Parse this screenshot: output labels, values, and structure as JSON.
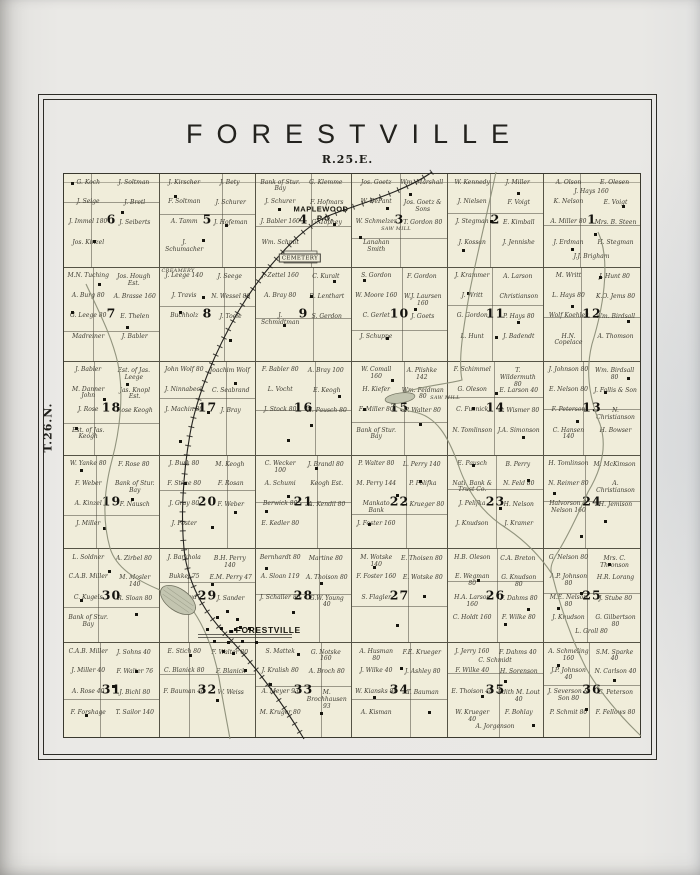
{
  "plate": {
    "title": "FORESTVILLE",
    "range_label": "R.25.E.",
    "township_label": "T.26.N."
  },
  "colors": {
    "paper": "#e8e7e4",
    "map_fill": "#f0edda",
    "grid_line": "#555345",
    "water": "#8b8e78",
    "railroad": "#23221e",
    "ink": "#17160f"
  },
  "map": {
    "sections": [
      {
        "number": 6,
        "names": [
          "G. Koch",
          "J. Soltman",
          "J. Seige",
          "J. Bretl",
          "J. Immel 180",
          "J. Seiberts",
          "Jos. Kinzel"
        ]
      },
      {
        "number": 5,
        "names": [
          "J. Kirscher",
          "J. Bety",
          "F. Soltman",
          "J. Schurer",
          "A. Tamm",
          "J. Hofeman",
          "J. Schumacher"
        ]
      },
      {
        "number": 4,
        "names": [
          "Bank of Stur. Bay",
          "G. Klemme",
          "J. Schurer",
          "F. Hofmars",
          "J. Babler 160",
          "G. Tophey",
          "Wm. Schmit"
        ]
      },
      {
        "number": 3,
        "names": [
          "Jos. Goetz",
          "Wm. Marshall",
          "W. DeFant",
          "Jos. Goetz & Sons",
          "W. Schmelzer",
          "T. Gordon 80",
          "Lanahan Smith"
        ]
      },
      {
        "number": 2,
        "names": [
          "W. Kennedy",
          "J. Miller",
          "J. Nielsen",
          "F. Voigt",
          "J. Stegman",
          "E. Kimball",
          "J. Kossan",
          "J. Jennishe"
        ]
      },
      {
        "number": 1,
        "names": [
          "A. Olson",
          "E. Olesen",
          "K. Nelson",
          "E. Voigt",
          "A. Miller 80",
          "Mrs. B. Steen",
          "J. Erdman",
          "H. Stegman",
          "J.J. Brigham",
          "J. Hays 160"
        ]
      },
      {
        "number": 7,
        "names": [
          "M.N. Tuching",
          "Jos. Hough Est.",
          "A. Burg 80",
          "A. Brasse 160",
          "G. Leege 80",
          "E. Thelen",
          "Madreiner",
          "J. Babler"
        ]
      },
      {
        "number": 8,
        "names": [
          "J. Leege 140",
          "J. Seege",
          "J. Travis",
          "N. Wessel 80",
          "Buchholz",
          "J. Toele"
        ]
      },
      {
        "number": 9,
        "names": [
          "J. Zettel 160",
          "C. Kuralt",
          "A. Bray 80",
          "R. Lenthart",
          "J. Schmidtman",
          "S. Gerdon"
        ]
      },
      {
        "number": 10,
        "names": [
          "S. Gordon",
          "F. Gordon",
          "W. Moore 160",
          "W.J. Laursen 160",
          "C. Gerlet",
          "J. Goets",
          "J. Schuppe"
        ]
      },
      {
        "number": 11,
        "names": [
          "J. Krammer",
          "A. Larson",
          "J. Writt",
          "Christianson",
          "G. Gordon",
          "P. Hays 80",
          "L. Hunt",
          "J. Badendt"
        ]
      },
      {
        "number": 12,
        "names": [
          "M. Writt",
          "J. Hunt 80",
          "L. Hays 80",
          "K.O. Jems 80",
          "Wolf Koehler",
          "Wm. Birdsall",
          "H.N. Copelace",
          "A. Thomson"
        ]
      },
      {
        "number": 18,
        "names": [
          "J. Babler",
          "Est. of Jas. Leege",
          "M. Danner John",
          "Jas. Knopl Est.",
          "J. Rose",
          "Rose Keogh",
          "Est. of Jas. Keogh"
        ]
      },
      {
        "number": 17,
        "names": [
          "John Wolf 80",
          "Joachim Wolf",
          "J. Ninnabeck",
          "C. Seabrand",
          "J. Machin 80",
          "J. Bray"
        ]
      },
      {
        "number": 16,
        "names": [
          "F. Babler 80",
          "A. Bray 100",
          "L. Vocht",
          "E. Keogh",
          "J. Stock 80",
          "H. Pausch 80"
        ]
      },
      {
        "number": 15,
        "names": [
          "W. Comall 160",
          "A. Plishke 142",
          "H. Kiefer",
          "Wm. Feldman 80",
          "F. Miller 80",
          "P. Walter 80",
          "Bank of Stur. Bay"
        ]
      },
      {
        "number": 14,
        "names": [
          "F. Schimmel",
          "T. Wildermuth 80",
          "G. Oleson",
          "E. Larson 40",
          "C. Fusnick",
          "C. Wismer 80",
          "N. Tomlinson",
          "J.A. Simonson"
        ]
      },
      {
        "number": 13,
        "names": [
          "J. Johnson 80",
          "Wm. Birdsall 80",
          "E. Nelson 80",
          "J. Fallis & Son",
          "F. Peterson",
          "N. Christianson",
          "C. Hansen 140",
          "H. Bowser"
        ]
      },
      {
        "number": 19,
        "names": [
          "W. Yanke 80",
          "F. Rose 80",
          "F. Weber",
          "Bank of Stur. Bay",
          "A. Kinzel",
          "F. Nausch",
          "J. Miller"
        ]
      },
      {
        "number": 20,
        "names": [
          "J. Burk 80",
          "M. Keogh",
          "F. Stilze 80",
          "F. Rosan",
          "J. Gray 80",
          "F. Weber",
          "J. Foster"
        ]
      },
      {
        "number": 21,
        "names": [
          "C. Wecker 100",
          "J. Brandl 80",
          "A. Schumi",
          "Keogh Est.",
          "Berwick 80",
          "A. Kendil 80",
          "E. Kedler 80"
        ]
      },
      {
        "number": 22,
        "names": [
          "P. Walter 80",
          "L. Perry 140",
          "M. Perry 144",
          "P. Polifka",
          "Mankato Bank",
          "C. Krueger 80",
          "J. Foster 160"
        ]
      },
      {
        "number": 23,
        "names": [
          "E. Pausch",
          "B. Perry",
          "Natl. Bank & Trust Co.",
          "N. Feld 80",
          "J. Pelifka",
          "H. Nelson",
          "J. Knudson",
          "J. Kramer"
        ]
      },
      {
        "number": 24,
        "names": [
          "H. Tomlinson",
          "M. McKimson",
          "N. Reimer 80",
          "A. Christianson",
          "Halvorson & Nelson 160",
          "H. Jemison"
        ]
      },
      {
        "number": 30,
        "names": [
          "L. Soldner",
          "A. Zirbel 80",
          "C.A.B. Miller",
          "M. Mosler 140",
          "C. Kugels",
          "R. Sloan 80",
          "Bank of Stur. Bay"
        ]
      },
      {
        "number": 29,
        "names": [
          "J. Barkhola",
          "B.H. Perry 140",
          "Bukkel 75",
          "E.M. Perry 47",
          "A. Rowd",
          "J. Sander"
        ]
      },
      {
        "number": 28,
        "names": [
          "Bernhardt 80",
          "Martine 80",
          "A. Sloan 119",
          "A. Thoison 80",
          "J. Schaller 80",
          "G.W. Young 40"
        ]
      },
      {
        "number": 27,
        "names": [
          "M. Wotske 140",
          "E. Thoisen 80",
          "F. Foster 160",
          "E. Wotske 80",
          "S. Flagler"
        ]
      },
      {
        "number": 26,
        "names": [
          "H.B. Oleson",
          "C.A. Breton",
          "E. Wegman 80",
          "G. Knudson 80",
          "H.A. Larson 160",
          "F. Dahms 80",
          "C. Holdt 160",
          "F. Wilke 80"
        ]
      },
      {
        "number": 25,
        "names": [
          "G. Nelson 80",
          "Mrs. C. Thronson",
          "A.P. Johnson 80",
          "H.R. Lorang",
          "M.E. Nelson 80",
          "J. Stube 80",
          "J. Knudson",
          "G. Gilbertson 80",
          "L. Groll 80"
        ]
      },
      {
        "number": 31,
        "names": [
          "C.A.B. Miller",
          "J. Sohns 40",
          "J. Miller 40",
          "F. Walter 76",
          "A. Rose 40",
          "J. Bichl 80",
          "F. Forshage",
          "T. Sailor 140"
        ]
      },
      {
        "number": 32,
        "names": [
          "E. Stich 80",
          "F. Walter 80",
          "C. Blanick 80",
          "F. Blanick",
          "F. Bauman 40",
          "W. Weiss"
        ]
      },
      {
        "number": 33,
        "names": [
          "S. Mattek",
          "G. Notske 160",
          "J. Kralish 80",
          "A. Broch 80",
          "A. Meyer 93",
          "M. Brochhausen 93",
          "M. Kruger 80"
        ]
      },
      {
        "number": 34,
        "names": [
          "A. Husman 80",
          "F.E. Krueger",
          "J. Wilke 40",
          "J. Ashley 80",
          "W. Kiansks 80",
          "T. Bauman",
          "A. Kisman"
        ]
      },
      {
        "number": 35,
        "names": [
          "J. Jerry 160",
          "F. Dahms 40",
          "F. Wilke 40",
          "H. Sorenson",
          "E. Thoison 40",
          "Edith M. Lout 40",
          "W. Krueger 40",
          "F. Bohlay",
          "A. Jorgenson",
          "C. Schmidt"
        ]
      },
      {
        "number": 36,
        "names": [
          "A. Schmeling 160",
          "S.M. Sparke 40",
          "J.P. Johnson 40",
          "N. Carlson 40",
          "J. Severson & Son 80",
          "C. Peterson",
          "P. Schmit 80",
          "F. Fellows 80"
        ]
      }
    ],
    "pois": [
      {
        "text": "MAPLEWOOD",
        "x": 321,
        "y": 209,
        "style": "place"
      },
      {
        "text": "P.O.",
        "x": 325,
        "y": 218,
        "style": "place"
      },
      {
        "text": "CEMETERY",
        "x": 300,
        "y": 258,
        "style": "box"
      },
      {
        "text": "CREAMERY",
        "x": 178,
        "y": 271,
        "style": "tiny"
      },
      {
        "text": "SAW MILL",
        "x": 396,
        "y": 229,
        "style": "tiny"
      },
      {
        "text": "SAW MILL",
        "x": 445,
        "y": 398,
        "style": "tiny"
      },
      {
        "text": "FORESTVILLE",
        "x": 265,
        "y": 630,
        "style": "town"
      }
    ],
    "features": [
      "railroad",
      "creek-east",
      "creek-west",
      "mill-pond",
      "village-cluster"
    ]
  }
}
